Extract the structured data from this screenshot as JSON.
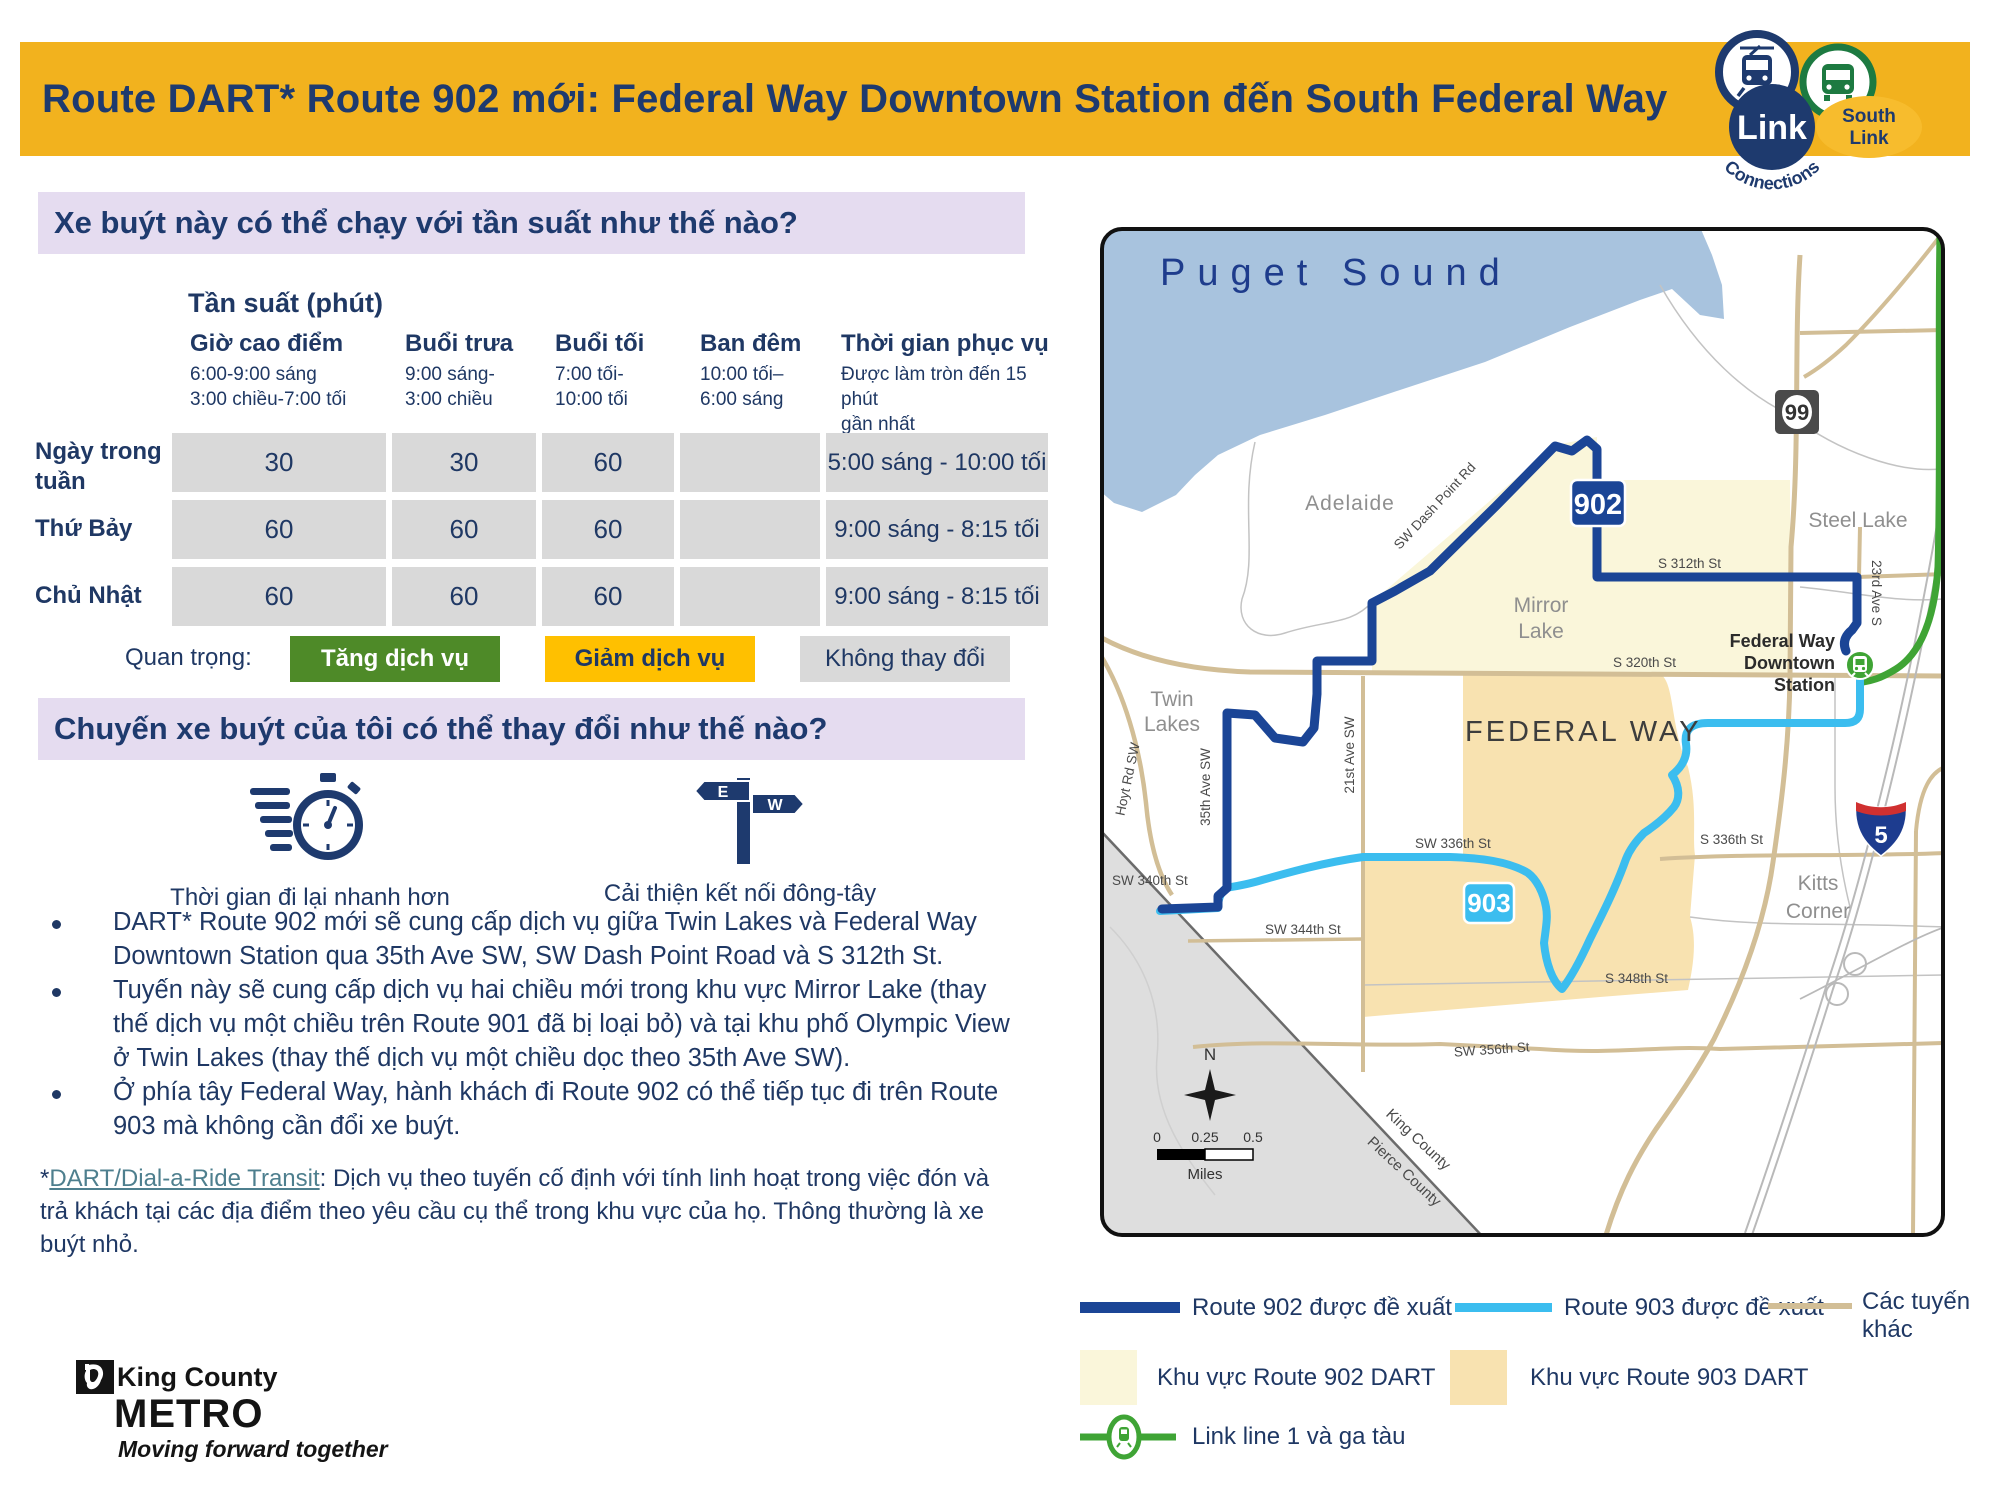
{
  "header": {
    "title": "Route DART* Route 902 mới: Federal Way Downtown Station đến South Federal Way",
    "logo": {
      "link": "Link",
      "connections": "Connections",
      "south_1": "South",
      "south_2": "Link"
    }
  },
  "colors": {
    "banner_gold": "#F2B21E",
    "navy": "#1F3864",
    "purple": "#E5DCF0",
    "increase_green": "#4E8A28",
    "decrease_gold": "#FFC000",
    "no_change_gray": "#D9D9D9",
    "route902": "#1B4596",
    "route903": "#3BBDEF",
    "link_green": "#3FA435",
    "dart902_area": "#FAF6DA",
    "dart903_area": "#F8E2B0",
    "water": "#A8C3DE"
  },
  "frequency_section": {
    "heading": "Xe buýt này có thể chạy với tần suất như thế nào?",
    "table_title": "Tần suất (phút)",
    "columns": [
      {
        "label": "Giờ cao điểm",
        "sub": "6:00-9:00 sáng\n3:00 chiều-7:00 tối"
      },
      {
        "label": "Buổi trưa",
        "sub": "9:00 sáng-\n3:00 chiều"
      },
      {
        "label": "Buổi tối",
        "sub": "7:00 tối-\n10:00 tối"
      },
      {
        "label": "Ban đêm",
        "sub": "10:00 tối–\n6:00 sáng"
      },
      {
        "label": "Thời gian phục vụ",
        "sub": "Được làm tròn đến 15 phút\ngần nhất"
      }
    ],
    "rows": [
      {
        "label": "Ngày trong tuần",
        "values": [
          "30",
          "30",
          "60",
          "",
          "5:00 sáng - 10:00 tối"
        ]
      },
      {
        "label": "Thứ Bảy",
        "values": [
          "60",
          "60",
          "60",
          "",
          "9:00 sáng - 8:15 tối"
        ]
      },
      {
        "label": "Chủ Nhật",
        "values": [
          "60",
          "60",
          "60",
          "",
          "9:00 sáng - 8:15 tối"
        ]
      }
    ],
    "importance_label": "Quan trọng:",
    "importance_items": [
      {
        "label": "Tăng dịch vụ"
      },
      {
        "label": "Giảm dịch vụ"
      },
      {
        "label": "Không thay đổi"
      }
    ]
  },
  "changes_section": {
    "heading": "Chuyến xe buýt của tôi có thể thay đổi như thế nào?",
    "benefits": [
      {
        "label": "Thời gian đi lại nhanh hơn"
      },
      {
        "label": "Cải thiện kết nối đông-tây"
      }
    ],
    "bullets": [
      "DART* Route 902 mới sẽ cung cấp dịch vụ giữa Twin Lakes và Federal Way Downtown Station qua 35th Ave SW, SW Dash Point Road và S 312th St.",
      "Tuyến này sẽ cung cấp dịch vụ hai chiều mới trong khu vực Mirror Lake (thay thế dịch vụ một chiều trên Route 901 đã bị loại bỏ) và tại khu phố Olympic View ở Twin Lakes (thay thế dịch vụ một chiều dọc theo 35th Ave SW).",
      "Ở phía tây Federal Way, hành khách đi Route 902 có thể tiếp tục đi trên Route 903 mà không cần đổi xe buýt."
    ],
    "footnote_star": "*",
    "footnote_link": "DART/Dial-a-Ride Transit",
    "footnote_rest": ": Dịch vụ theo tuyến cố định với tính linh hoạt trong việc đón và trả khách tại các địa điểm theo yêu cầu cụ thể trong khu vực của họ. Thông thường là xe buýt nhỏ."
  },
  "metro_logo": {
    "line1": "King County",
    "line2": "METRO",
    "tagline": "Moving forward together"
  },
  "map": {
    "water_label": "Puget Sound",
    "places": {
      "adelaide": "Adelaide",
      "twin_1": "Twin",
      "twin_2": "Lakes",
      "mirror_1": "Mirror",
      "mirror_2": "Lake",
      "steel_lake": "Steel Lake",
      "federal_way": "FEDERAL WAY",
      "kitts_1": "Kitts",
      "kitts_2": "Corner"
    },
    "streets": {
      "dash_point": "SW Dash Point Rd",
      "s312": "S 312th St",
      "s320": "S 320th St",
      "ave23": "23rd Ave S",
      "ave21": "21st Ave SW",
      "ave35": "35th Ave SW",
      "hoyt": "Hoyt Rd SW",
      "sw336": "SW 336th St",
      "s336": "S 336th St",
      "sw340": "SW 340th St",
      "sw344": "SW 344th St",
      "s348": "S 348th St",
      "sw356": "SW 356th St"
    },
    "county": {
      "king": "King County",
      "pierce": "Pierce County"
    },
    "station": {
      "l1": "Federal Way",
      "l2": "Downtown",
      "l3": "Station"
    },
    "badges": {
      "route902": "902",
      "route903": "903",
      "sr99": "99",
      "i5": "5"
    },
    "compass_n": "N",
    "scale": {
      "t0": "0",
      "t1": "0.25",
      "t2": "0.5",
      "unit": "Miles"
    },
    "legend": {
      "route902": "Route 902 được đề xuất",
      "route903": "Route 903 được đề xuất",
      "other": "Các tuyến khác",
      "dart902": "Khu vực Route 902 DART",
      "dart903": "Khu vực Route 903 DART",
      "link": "Link line 1 và ga tàu"
    }
  }
}
